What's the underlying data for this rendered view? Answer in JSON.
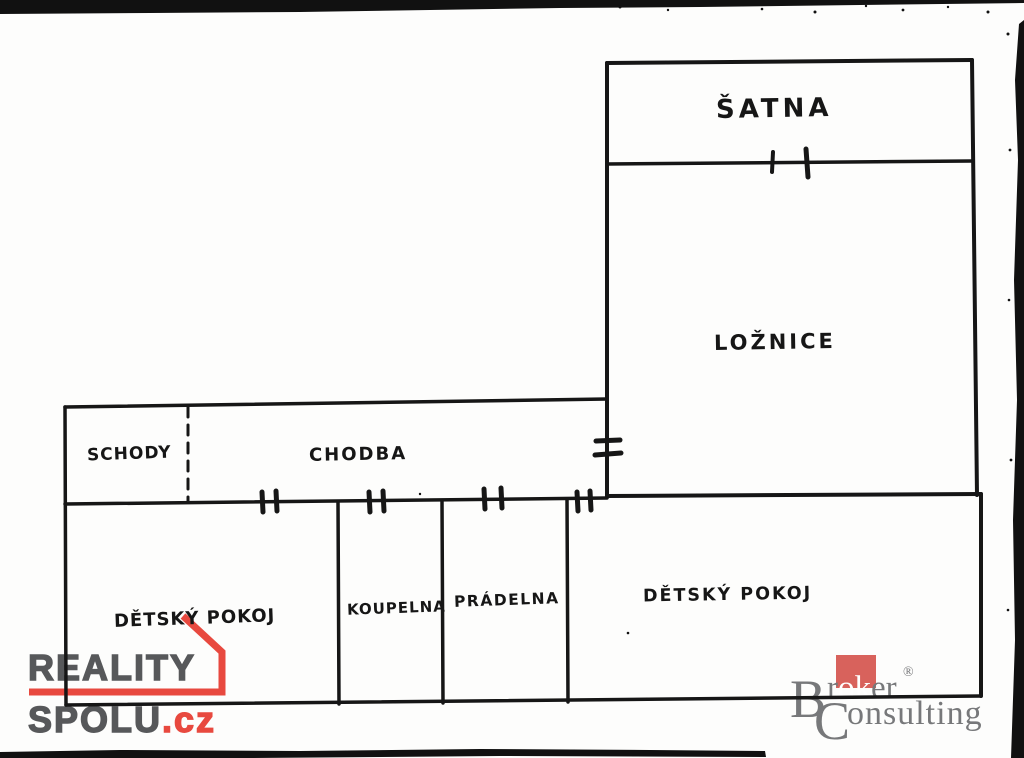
{
  "ink_color": "#161616",
  "rooms": {
    "satna": "ŠATNA",
    "loznice": "LOŽNICE",
    "schody": "SCHODY",
    "chodba": "CHODBA",
    "detsky_pokoj_left": "DĚTSKÝ POKOJ",
    "koupelna": "KOUPELNA",
    "pradelna": "PRÁDELNA",
    "detsky_pokoj_right": "DĚTSKÝ POKOJ"
  },
  "branding": {
    "reality_spolu": {
      "word_top": "REALITY",
      "word_bottom": "SPOLU",
      "suffix": ".cz",
      "text_color": "#57585a",
      "accent_color": "#e8493f"
    },
    "broker_consulting": {
      "initial_top": "B",
      "top_pre": "r",
      "top_highlight": "ok",
      "top_post": "er",
      "registered_mark": "®",
      "initial_bottom": "C",
      "bottom_rest": "onsulting",
      "text_color": "#77787a",
      "accent_color": "#d8625c"
    }
  }
}
